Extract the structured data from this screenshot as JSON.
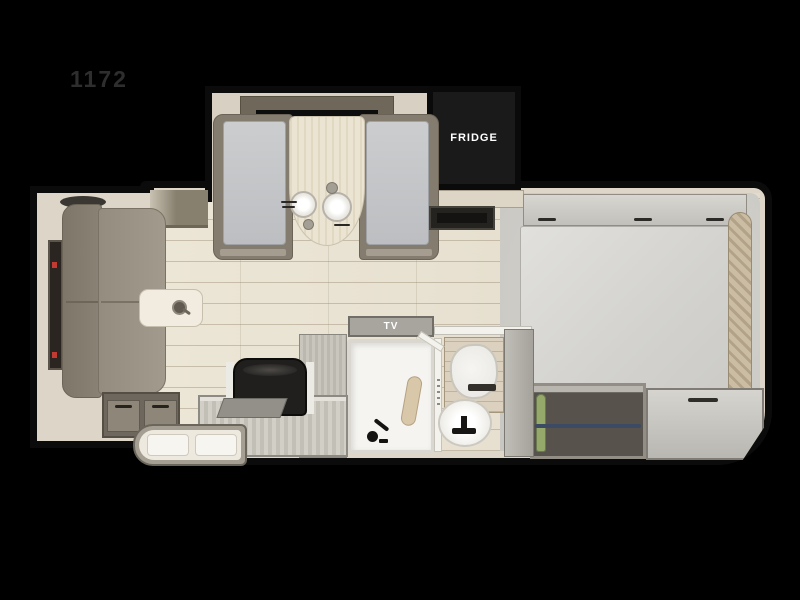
{
  "floorplan": {
    "model_label": "1172",
    "appliances": {
      "fridge_label": "FRIDGE",
      "tv_label": "TV"
    },
    "wardrobe": {
      "hangers": [
        "blue",
        "green",
        "blue",
        "blue",
        "green",
        "blue",
        "blue",
        "green",
        "green"
      ]
    },
    "colors": {
      "background": "#000000",
      "wall_outline": "#0b0b0b",
      "wall_fill": "#ded7c9",
      "floor_plank": "#e9e3d4",
      "bedroom_carpet": "#cdccc8",
      "sofa": "#90887a",
      "dinette_cushion": "#c6c8ca",
      "table": "#ece4d2",
      "fridge": "#1a1a1a",
      "bed": "#dcdbd7",
      "hanger_blue": "#7b93ae",
      "hanger_green": "#95a96b"
    }
  }
}
